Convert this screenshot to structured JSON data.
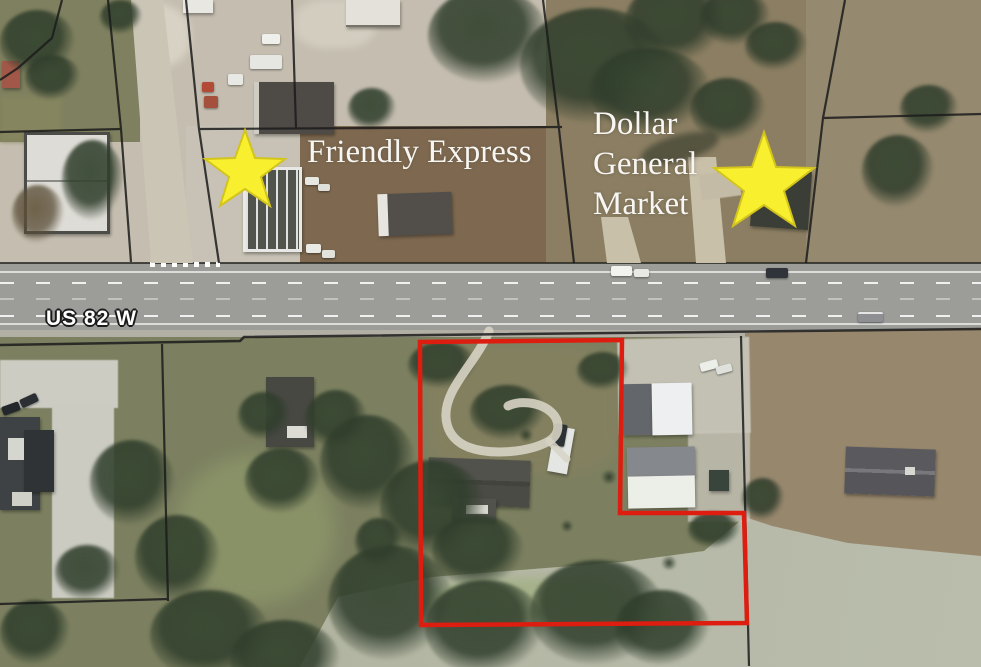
{
  "map": {
    "road_label": "US 82 W",
    "annotations": {
      "friendly_express": {
        "label": "Friendly Express"
      },
      "dollar_general": {
        "line1": "Dollar",
        "line2": "General",
        "line3": "Market"
      }
    },
    "colors": {
      "star_yellow": "#f8ef2f",
      "star_edge": "#d3c41d",
      "boundary_red": "#dd1d10",
      "parcel_line_black": "#1c1c1c",
      "road_gray": "#9c9d99",
      "label_white": "#f7f6f2"
    },
    "boundary": {
      "points": "420,342 622,340 620,513 744,513 747,623 421,625"
    },
    "stars": {
      "friendly_express_points": "245,130 255,158 285,159 261,177 270,206 245,189 220,206 229,177 205,159 235,158",
      "dollar_general_points": "764,132 776,167 814,168 784,191 795,226 764,205 733,226 744,191 714,168 752,167"
    }
  }
}
